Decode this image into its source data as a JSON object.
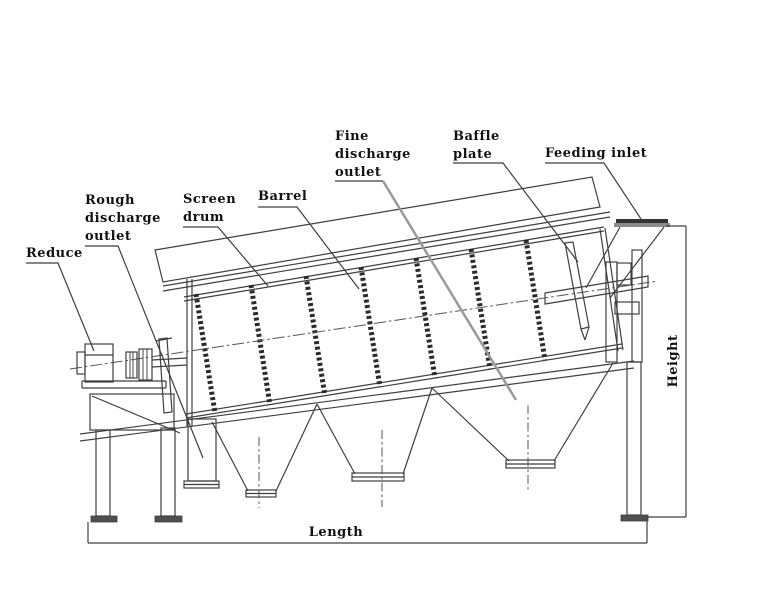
{
  "diagram_type": "trommel-screen-machine-side-view",
  "labels": {
    "reduce": "Reduce",
    "rough_discharge_outlet": [
      "Rough",
      "discharge",
      "outlet"
    ],
    "screen_drum": [
      "Screen",
      "drum"
    ],
    "barrel": "Barrel",
    "fine_discharge_outlet": [
      "Fine",
      "discharge",
      "outlet"
    ],
    "baffle_plate": [
      "Baffle",
      "plate"
    ],
    "feeding_inlet": "Feeding inlet",
    "dimensions": {
      "height": "Height",
      "length": "Length"
    }
  },
  "colors": {
    "line": "#3f3f3f",
    "ring_bar": "#2b2b2b",
    "fine_outlet_leader": "#9a9a9a",
    "foot_fill": "#4f4f4f",
    "inlet_plate_dark": "#333333",
    "inlet_plate_gray": "#8a8a8a",
    "background": "#ffffff"
  }
}
